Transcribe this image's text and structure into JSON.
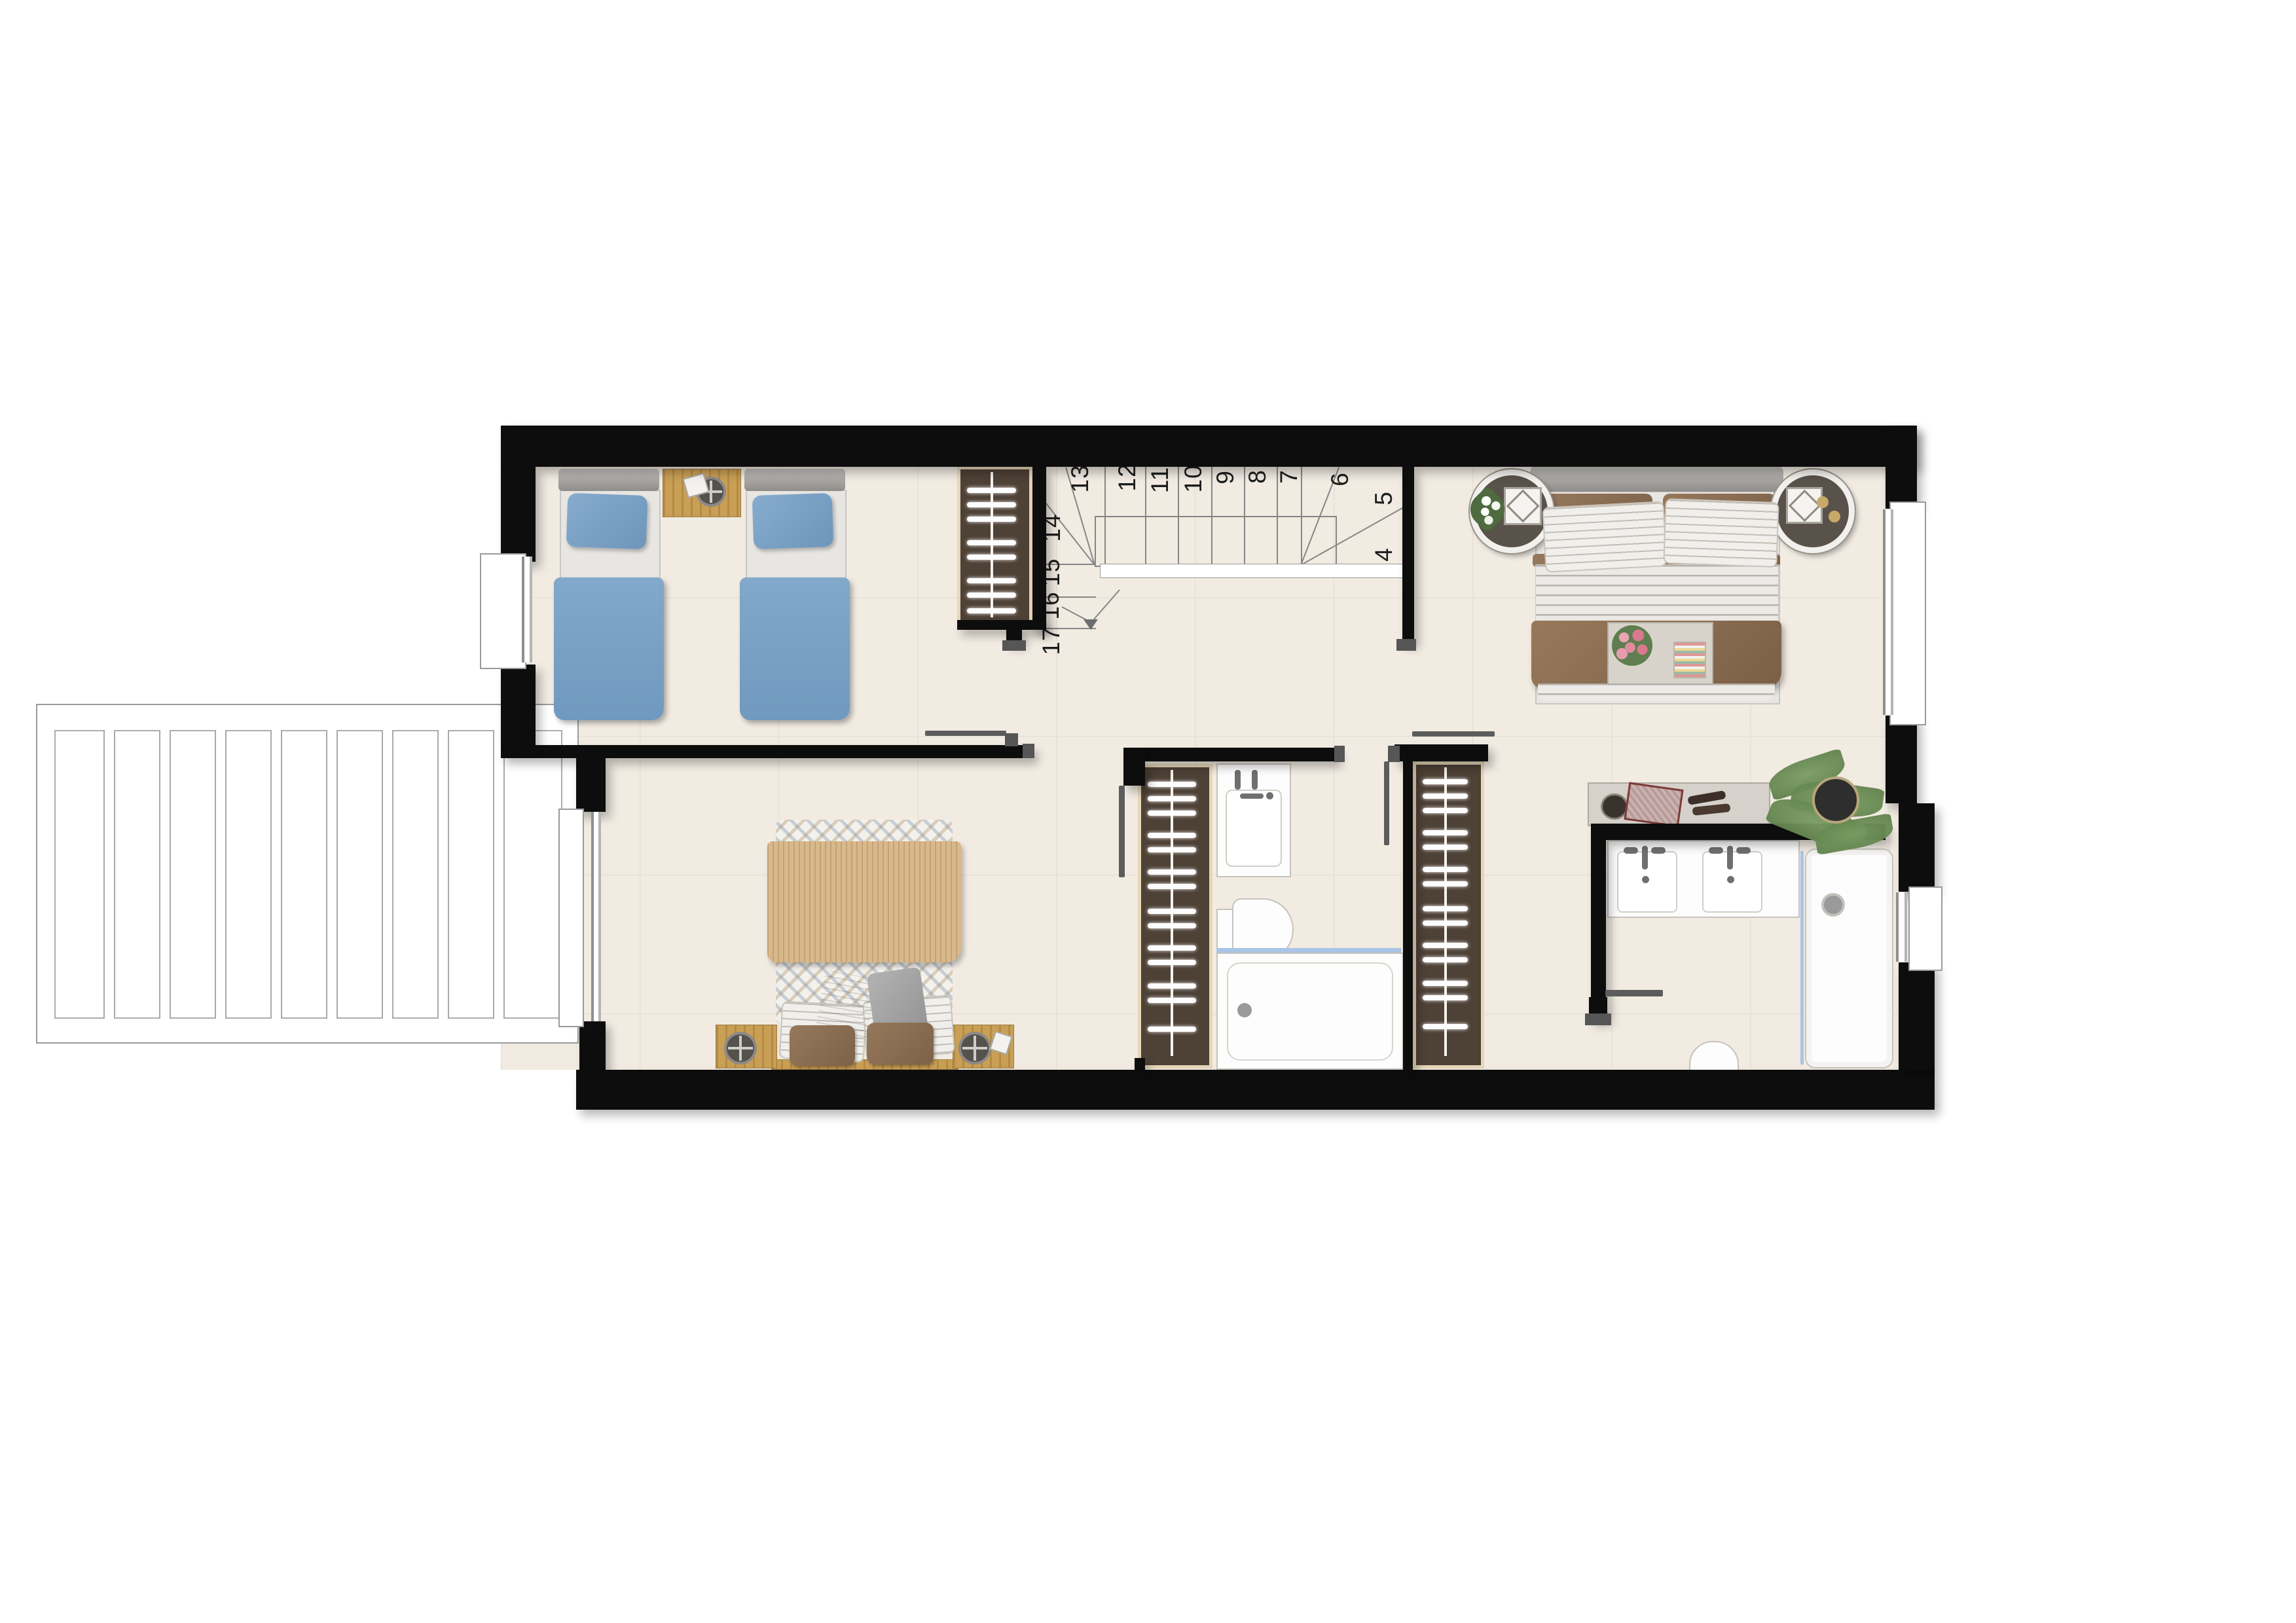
{
  "document": {
    "type": "floor-plan",
    "view": "top-down",
    "floor_label": ""
  },
  "stairs": {
    "numbers": [
      "4",
      "5",
      "6",
      "7",
      "8",
      "9",
      "10",
      "11",
      "12",
      "13",
      "14",
      "15",
      "16",
      "17"
    ]
  },
  "rooms": [
    {
      "id": "bedroom-twin",
      "furniture": [
        "single-bed",
        "single-bed",
        "nightstand"
      ]
    },
    {
      "id": "bedroom-double",
      "furniture": [
        "double-bed",
        "nightstand",
        "nightstand"
      ]
    },
    {
      "id": "bedroom-master",
      "furniture": [
        "double-bed",
        "round-nightstand",
        "round-nightstand",
        "desk",
        "plant"
      ]
    },
    {
      "id": "bathroom-family",
      "fixtures": [
        "washbasin",
        "toilet",
        "bathtub"
      ]
    },
    {
      "id": "bathroom-ensuite",
      "fixtures": [
        "double-washbasin",
        "toilet",
        "shower"
      ]
    },
    {
      "id": "hall-landing"
    },
    {
      "id": "staircase"
    },
    {
      "id": "terrace-pergola"
    },
    {
      "id": "wardrobe",
      "count": 3
    }
  ],
  "icons": [
    "faucet-icon",
    "drain-icon",
    "flower-icon",
    "plant-icon",
    "tray-icon",
    "arrow-down-icon"
  ],
  "colors": {
    "wall": "#0d0d0d",
    "floor": "#f1ebe2",
    "bed_blue": "#7ba3c8",
    "linen_brown": "#8a6c4f",
    "knit_tan": "#d9b88c",
    "wood": "#c89f55",
    "wardrobe_brown": "#4e4136",
    "wardrobe_frame": "#e6d7b8",
    "glass_blue": "#a9c4e4",
    "door_gray": "#5c5c5c",
    "terrace_line": "#9a9a9a"
  }
}
